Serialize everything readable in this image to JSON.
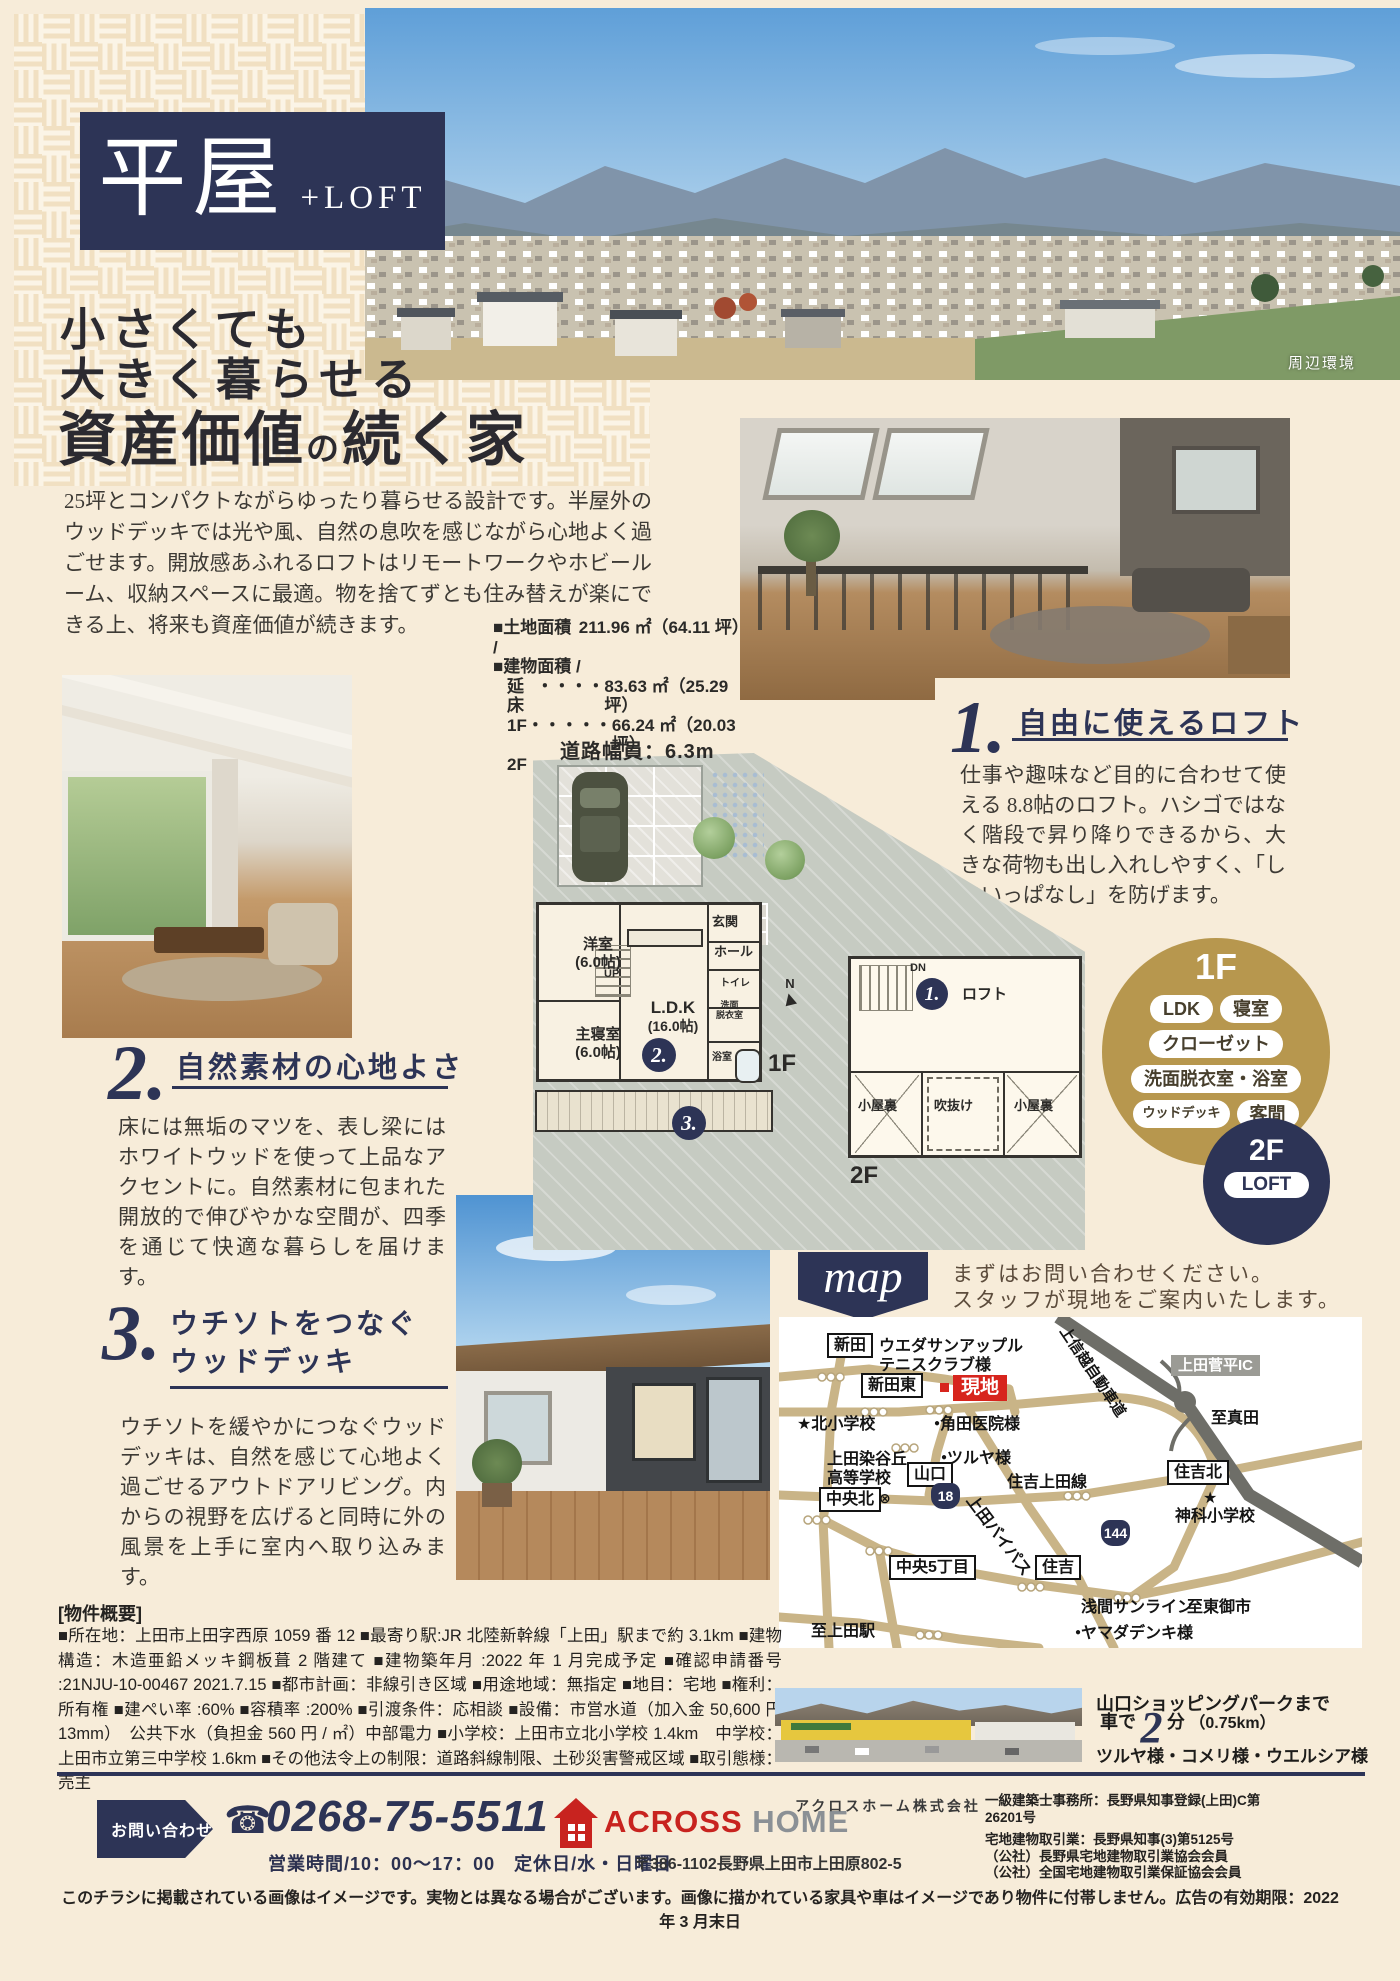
{
  "page": {
    "title_main": "平屋",
    "title_sub": "+LOFT",
    "catch_line1": "小さくても",
    "catch_line2": "大きく暮らせる",
    "catch3_emph1": "資産価値",
    "catch3_particle": "の",
    "catch3_emph2": "続く家",
    "photo_caption": "周辺環境",
    "intro": "25坪とコンパクトながらゆったり暮らせる設計です。半屋外のウッドデッキでは光や風、自然の息吹を感じながら心地よく過ごせます。開放感あふれるロフトはリモートワークやホビールーム、収納スペースに最適。物を捨てずとも住み替えが楽にできる上、将来も資産価値が続きます。"
  },
  "areas": {
    "land_label": "■土地面積 /",
    "land_value": "211.96 ㎡（64.11 坪）",
    "building_label": "■建物面積 /",
    "rows": [
      {
        "name": "延床",
        "dots": "・・・・",
        "value": "83.63 ㎡（25.29 坪）"
      },
      {
        "name": "1F",
        "dots": "・・・・・",
        "value": "66.24 ㎡（20.03 坪）"
      },
      {
        "name": "2F",
        "dots": "・・・・・",
        "value": "17.39 ㎡（05.26 坪）"
      }
    ]
  },
  "points": [
    {
      "num": "1.",
      "title": "自由に使えるロフト",
      "body": "仕事や趣味など目的に合わせて使える 8.8帖のロフト。ハシゴではなく階段で昇り降りできるから、大きな荷物も出し入れしやすく、「しまいっぱなし」を防げます。"
    },
    {
      "num": "2.",
      "title": "自然素材の心地よさ",
      "body": "床には無垢のマツを、表し梁にはホワイトウッドを使って上品なアクセントに。自然素材に包まれた開放的で伸びやかな空間が、四季を通じて快適な暮らしを届けます。"
    },
    {
      "num": "3.",
      "title_line1": "ウチソトをつなぐ",
      "title_line2": "ウッドデッキ",
      "body": "ウチソトを緩やかにつなぐウッドデッキは、自然を感じて心地よく過ごせるアウトドアリビング。内からの視野を広げると同時に外の風景を上手に室内へ取り込みます。"
    }
  ],
  "floorplan": {
    "road_width": "道路幅員：6.3m",
    "north": "N",
    "f1_label": "1F",
    "f2_label": "2F",
    "up": "UP",
    "dn": "DN",
    "rooms": {
      "yoshitsu": "洋室",
      "yoshitsu_size": "(6.0帖)",
      "shinshitsu": "主寝室",
      "shinshitsu_size": "(6.0帖)",
      "ldk": "L.D.K",
      "ldk_size": "(16.0帖)",
      "genkan": "玄関",
      "hall": "ホール",
      "toilet": "トイレ",
      "senmen": "洗面",
      "datsui": "脱衣室",
      "bath": "浴室",
      "loft": "ロフト",
      "koyaura_left": "小屋裏",
      "koyaura_right": "小屋裏",
      "fukinuke": "吹抜け"
    }
  },
  "badges": {
    "f1_title": "1F",
    "f1_items": [
      "LDK",
      "寝室",
      "クローゼット",
      "洗面脱衣室・浴室",
      "ウッドデッキ",
      "客間"
    ],
    "f2_title": "2F",
    "f2_item": "LOFT"
  },
  "map": {
    "banner": "map",
    "lead1": "まずはお問い合わせください。",
    "lead2": "スタッフが現地をご案内いたします。",
    "icons": {
      "star": "★",
      "dot": "●",
      "circle_cross": "⊗"
    },
    "labels": {
      "shinden": "新田",
      "tennis1": "ウエダサンアップル",
      "tennis2": "テニスクラブ様",
      "shinden_higashi": "新田東",
      "genchi": "現地",
      "expressway": "上信越自動車道",
      "ic": "上田菅平IC",
      "to_sanada": "至真田",
      "kita_elementary": "北小学校",
      "kakuta_clinic": "角田医院様",
      "someyaoka1": "上田染谷丘",
      "someyaoka2": "高等学校",
      "tsuruya": "ツルヤ様",
      "yamaguchi": "山口",
      "chuo_kita": "中央北",
      "route18": "18",
      "sumiyoshi_ueda_line": "住吉上田線",
      "sumiyoshi_kita": "住吉北",
      "kamishina_elementary": "神科小学校",
      "route144": "144",
      "ueda_bypass": "上田バイパス",
      "chuo5": "中央5丁目",
      "sumiyoshi": "住吉",
      "asama_sunline": "浅間サンライン",
      "to_tomi": "至東御市",
      "to_ueda_sta": "至上田駅",
      "yamada_denki": "ヤマダデンキ様"
    }
  },
  "overview": {
    "heading": "[物件概要]",
    "body": "■所在地：上田市上田字西原 1059 番 12 ■最寄り駅:JR 北陸新幹線「上田」駅まで約 3.1km ■建物構造：木造亜鉛メッキ鋼板葺 2 階建て ■建物築年月 :2022 年 1 月完成予定 ■確認申請番号 :21NJU-10-00467 2021.7.15 ■都市計画：非線引き区域 ■用途地域：無指定 ■地目：宅地 ■権利：所有権 ■建ぺい率 :60% ■容積率 :200% ■引渡条件：応相談 ■設備：市営水道（加入金 50,600 円 13mm）　公共下水（負担金 560 円 / ㎡）中部電力 ■小学校：上田市立北小学校 1.4km　中学校：上田市立第三中学校 1.6km ■その他法令上の制限：道路斜線制限、土砂災害警戒区域 ■取引態様：売主"
  },
  "shopping": {
    "line1": "山口ショッピングパークまで",
    "drive_prefix": "車で",
    "minutes": "2",
    "drive_suffix": "分",
    "distance": "（0.75km）",
    "stores": "ツルヤ様・コメリ様・ウエルシア様"
  },
  "footer": {
    "contact_label": "お問い合わせ",
    "phone_icon_glyph": "☎",
    "phone": "0268-75-5511",
    "hours": "営業時間/10：00～17：00　定休日/水・日曜日",
    "company_kana": "アクロスホーム株式会社",
    "logo_across": "ACROSS",
    "logo_home": "HOME",
    "address": "〒386-1102長野県上田市上田原802-5",
    "license1": "一級建築士事務所：長野県知事登録(上田)C第26201号",
    "license2": "宅地建物取引業：長野県知事(3)第5125号",
    "license3": "（公社）長野県宅地建物取引業協会会員",
    "license4": "（公社）全国宅地建物取引業保証協会会員",
    "disclaimer": "このチラシに掲載されている画像はイメージです。実物とは異なる場合がございます。画像に描かれている家具や車はイメージであり物件に付帯しません。広告の有効期限：2022 年 3 月末日"
  }
}
